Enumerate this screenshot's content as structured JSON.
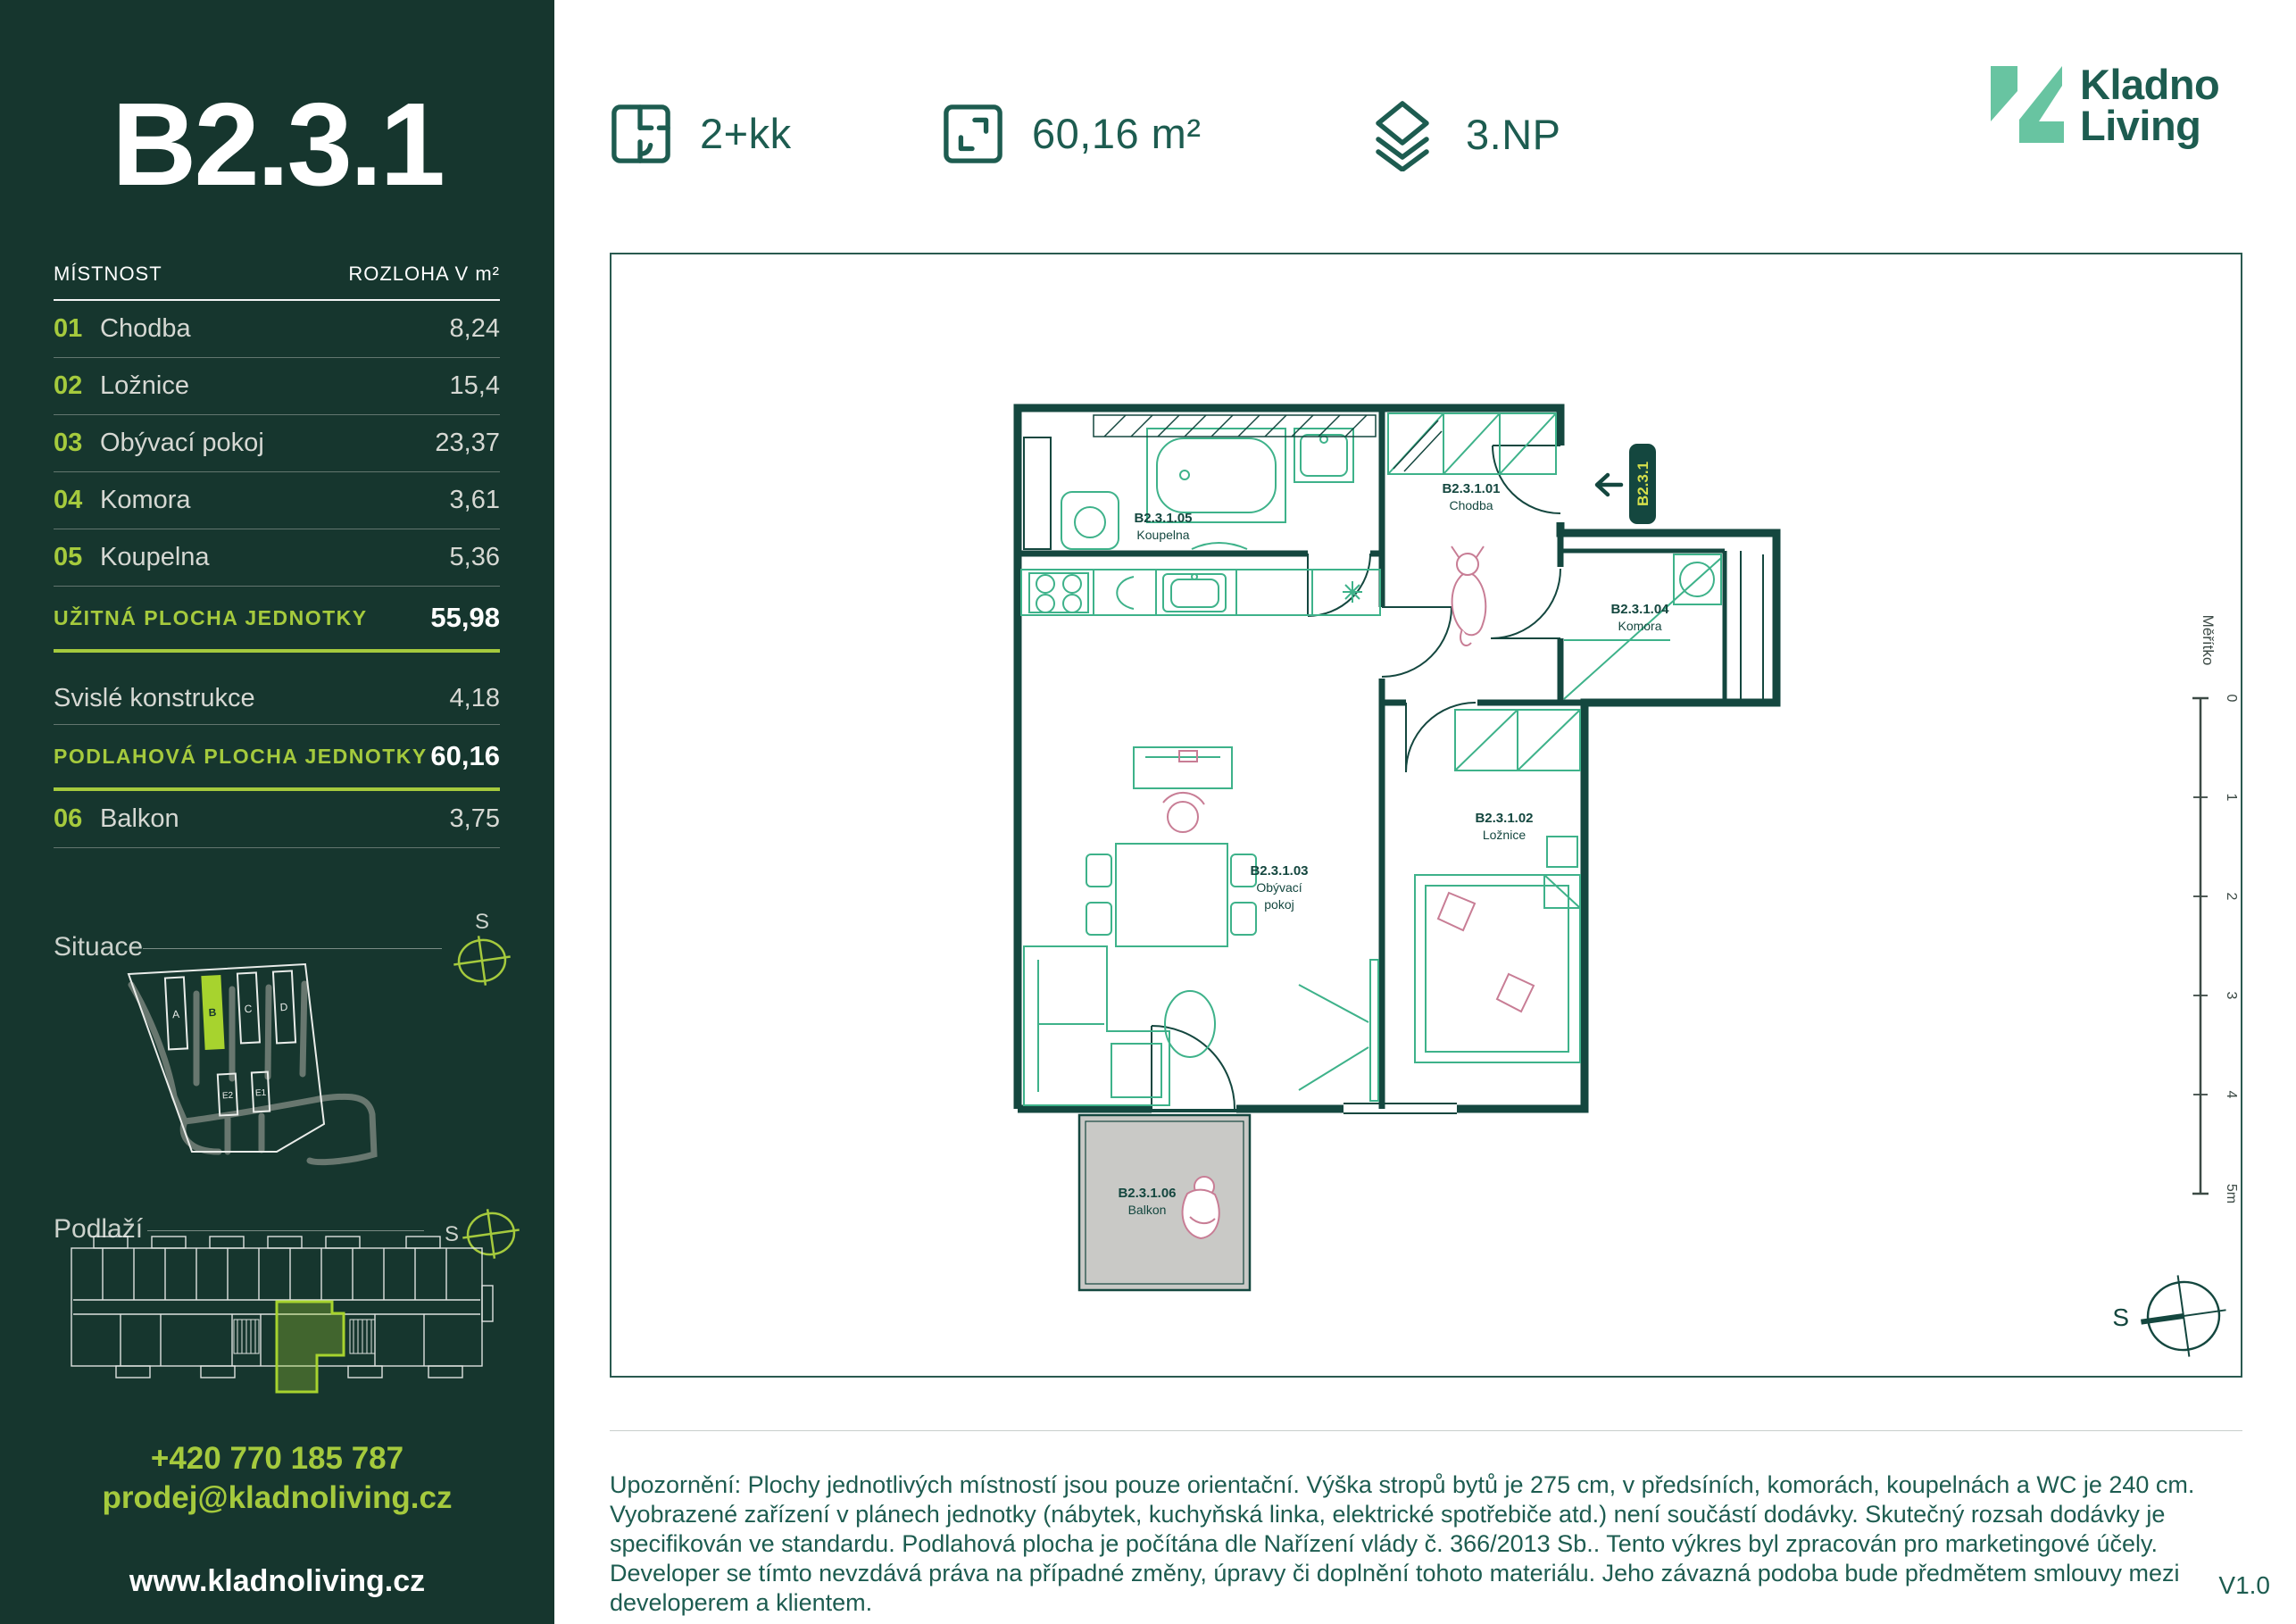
{
  "unit": {
    "id": "B2.3.1",
    "layout": "2+kk",
    "area": "60,16 m²",
    "floor": "3.NP"
  },
  "brand": {
    "name_line1": "Kladno",
    "name_line2": "Living"
  },
  "sidebar": {
    "table": {
      "col_room": "MÍSTNOST",
      "col_area": "ROZLOHA V m²",
      "rooms": [
        {
          "num": "01",
          "name": "Chodba",
          "area": "8,24"
        },
        {
          "num": "02",
          "name": "Ložnice",
          "area": "15,4"
        },
        {
          "num": "03",
          "name": "Obývací pokoj",
          "area": "23,37"
        },
        {
          "num": "04",
          "name": "Komora",
          "area": "3,61"
        },
        {
          "num": "05",
          "name": "Koupelna",
          "area": "5,36"
        }
      ],
      "usable_label": "UŽITNÁ PLOCHA JEDNOTKY",
      "usable_value": "55,98",
      "vertical_label": "Svislé konstrukce",
      "vertical_value": "4,18",
      "floor_area_label": "PODLAHOVÁ PLOCHA JEDNOTKY",
      "floor_area_value": "60,16",
      "balcony": {
        "num": "06",
        "name": "Balkon",
        "area": "3,75"
      }
    },
    "situace_label": "Situace",
    "podlazi_label": "Podlaží",
    "site_buildings": [
      "A",
      "B",
      "C",
      "D",
      "E2",
      "E1"
    ],
    "contact": {
      "phone": "+420 770 185 787",
      "email": "prodej@kladnoliving.cz",
      "web": "www.kladnoliving.cz"
    }
  },
  "plan": {
    "badge": "B2.3.1",
    "rooms": {
      "chodba": {
        "code": "B2.3.1.01",
        "name": "Chodba"
      },
      "loznice": {
        "code": "B2.3.1.02",
        "name": "Ložnice"
      },
      "obyvaci": {
        "code": "B2.3.1.03",
        "name_line1": "Obývací",
        "name_line2": "pokoj"
      },
      "komora": {
        "code": "B2.3.1.04",
        "name": "Komora"
      },
      "koupelna": {
        "code": "B2.3.1.05",
        "name": "Koupelna"
      },
      "balkon": {
        "code": "B2.3.1.06",
        "name": "Balkon"
      }
    },
    "scale": {
      "label": "Měřítko",
      "ticks": [
        "0",
        "1",
        "2",
        "3",
        "4",
        "5m"
      ]
    }
  },
  "compass": {
    "letter": "S"
  },
  "footer": {
    "disclaimer": "Upozornění: Plochy jednotlivých místností jsou pouze orientační. Výška stropů bytů je 275 cm, v předsíních, komorách, koupelnách a WC je 240 cm. Vyobrazené zařízení v plánech jednotky (nábytek, kuchyňská linka, elektrické spotřebiče atd.) není součástí dodávky. Skutečný rozsah dodávky je specifikován ve standardu. Podlahová plocha je počítána dle Nařízení vlády č. 366/2013 Sb.. Tento výkres byl zpracován pro marketingové účely. Developer se tímto nevzdává práva na případné změny, úpravy či doplnění tohoto materiálu. Jeho závazná podoba bude předmětem smlouvy mezi developerem a klientem.",
    "version": "V1.0"
  },
  "colors": {
    "sidebar_bg": "#16362e",
    "accent_lime": "#a5ca3d",
    "badge_text_lime": "#d6e04b",
    "wall_green": "#14473f",
    "furniture_teal": "#3eb28a",
    "accent_pink": "#c87d95",
    "text_green": "#1d5c50",
    "brand_mint": "#68c4a1",
    "balcony_gray": "#c9c9c6"
  }
}
